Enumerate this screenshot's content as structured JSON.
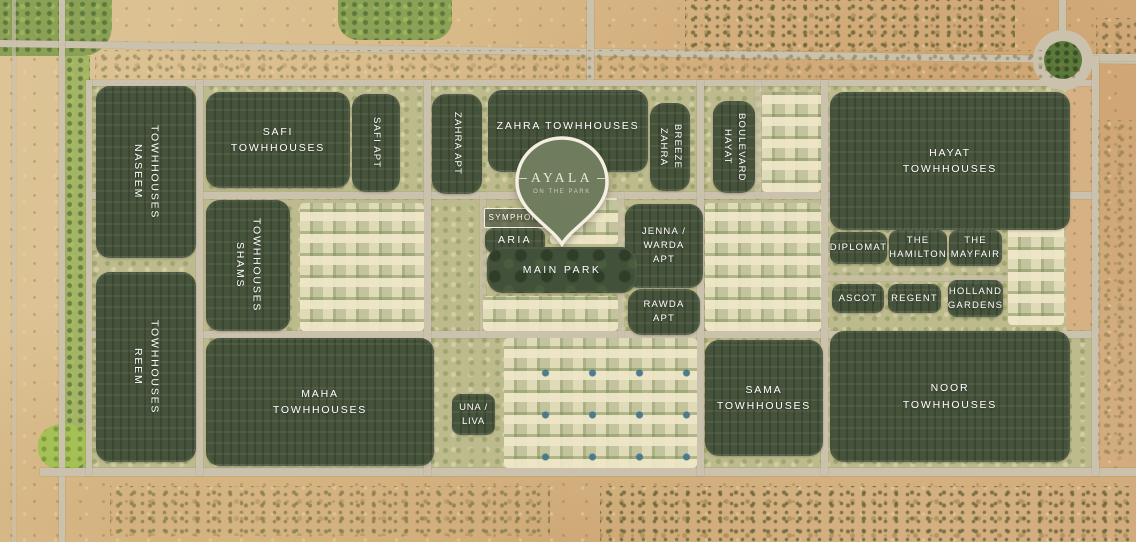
{
  "brand": {
    "name": "AYALA",
    "tagline": "ON THE PARK"
  },
  "zones": {
    "naseem": {
      "label": "NASEEM\nTOWHHOUSES"
    },
    "safi_town": {
      "label": "SAFI\nTOWHHOUSES"
    },
    "safi_apt": {
      "label": "SAFI APT"
    },
    "zahra_apt": {
      "label": "ZAHRA APT"
    },
    "zahra_town": {
      "label": "ZAHRA TOWHHOUSES"
    },
    "zahra_breeze": {
      "label": "ZAHRA\nBREEZE"
    },
    "hayat_blvd": {
      "label": "HAYAT\nBOULEVARD"
    },
    "hayat_town": {
      "label": "HAYAT\nTOWHHOUSES"
    },
    "shams": {
      "label": "SHAMS\nTOWHHOUSES"
    },
    "symphony": {
      "label": "SYMPHONY"
    },
    "aria": {
      "label": "ARIA"
    },
    "jenna_warda": {
      "label": "JENNA /\nWARDA\nAPT"
    },
    "main_park": {
      "label": "MAIN PARK"
    },
    "rawda": {
      "label": "RAWDA\nAPT"
    },
    "diplomat": {
      "label": "DIPLOMAT"
    },
    "hamilton": {
      "label": "THE\nHAMILTON"
    },
    "mayfair": {
      "label": "THE\nMAYFAIR"
    },
    "ascot": {
      "label": "ASCOT"
    },
    "regent": {
      "label": "REGENT"
    },
    "holland": {
      "label": "HOLLAND\nGARDENS"
    },
    "reem": {
      "label": "REEM\nTOWHHOUSES"
    },
    "maha": {
      "label": "MAHA\nTOWHHOUSES"
    },
    "una_liva": {
      "label": "UNA /\nLIVA"
    },
    "sama": {
      "label": "SAMA\nTOWHHOUSES"
    },
    "noor": {
      "label": "NOOR\nTOWHHOUSES"
    }
  },
  "colors": {
    "zone_green": "#46533b",
    "desert_sand": "#d8ba88",
    "road": "#cbc2ad",
    "label_text": "#ffffff",
    "pin_fill": "#6f7c5e",
    "pin_border": "#f3efe1"
  }
}
